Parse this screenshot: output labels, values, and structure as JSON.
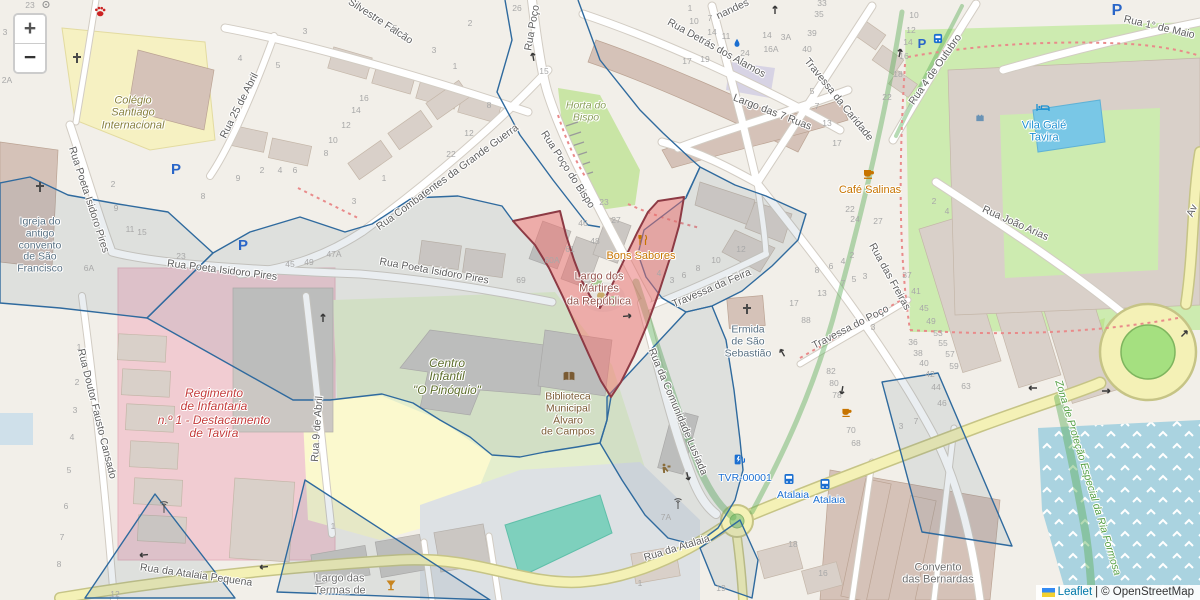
{
  "map": {
    "controls": {
      "zoom_in": "+",
      "zoom_out": "−"
    },
    "attribution": {
      "leaflet": "Leaflet",
      "separator": "|",
      "copyright": "© OpenStreetMap"
    },
    "colors": {
      "street_label": "#5f5f5f",
      "housenumber": "#a8a8a8",
      "poi_orange": "#c77400",
      "poi_blue": "#1a8fd1",
      "poi_transit_blue": "#1b6fd1",
      "church_label": "#587082",
      "school_label": "#88813d",
      "kindergarten_label": "#5d6e2c",
      "military_label": "#c43c3c",
      "square_label": "#96544d",
      "library_label": "#7a5b33",
      "protection_label": "#55a044",
      "place_label": "#6e6e6e",
      "green_area_label": "#8ba05a",
      "selection_outline": "#2f6a9e",
      "highlight_fill": "#e76a6a",
      "highlight_border": "#8d3a44"
    },
    "labels": [
      {
        "t": "Silvestre Falcão",
        "x": 380,
        "y": 22,
        "rot": 33,
        "cls": "street"
      },
      {
        "t": "Rua Detrás dos Alamos",
        "x": 716,
        "y": 49,
        "rot": 29,
        "cls": "street"
      },
      {
        "t": "nandes",
        "x": 733,
        "y": 10,
        "rot": -25,
        "cls": "street"
      },
      {
        "t": "Rua Poço",
        "x": 533,
        "y": 28,
        "rot": -80,
        "cls": "street"
      },
      {
        "t": "Rua Poço do Bispo",
        "x": 567,
        "y": 170,
        "rot": 57,
        "cls": "street"
      },
      {
        "t": "Rua Combatentes da Grande Guerra",
        "x": 448,
        "y": 178,
        "rot": -36,
        "cls": "street"
      },
      {
        "t": "Rua 25 de Abril",
        "x": 240,
        "y": 106,
        "rot": -63,
        "cls": "street"
      },
      {
        "t": "Rua Poeta Isidoro Pires",
        "x": 88,
        "y": 200,
        "rot": 72,
        "cls": "street"
      },
      {
        "t": "Rua Poeta Isidoro Pires",
        "x": 222,
        "y": 271,
        "rot": 7,
        "cls": "street"
      },
      {
        "t": "Rua Poeta Isidoro Pires",
        "x": 434,
        "y": 272,
        "rot": 10,
        "cls": "street"
      },
      {
        "t": "Largo das 7 Ruas",
        "x": 772,
        "y": 113,
        "rot": 21,
        "cls": "street"
      },
      {
        "t": "Travessa da Caridade",
        "x": 838,
        "y": 100,
        "rot": 51,
        "cls": "street"
      },
      {
        "t": "Rua 4 de Outubro",
        "x": 936,
        "y": 70,
        "rot": -55,
        "cls": "street"
      },
      {
        "t": "Rua 1° de Maio",
        "x": 1159,
        "y": 28,
        "rot": 13,
        "cls": "street"
      },
      {
        "t": "Rua João Arias",
        "x": 1015,
        "y": 224,
        "rot": 24,
        "cls": "street"
      },
      {
        "t": "Rua das Freiras",
        "x": 889,
        "y": 277,
        "rot": 61,
        "cls": "street"
      },
      {
        "t": "Travessa do Poço",
        "x": 851,
        "y": 328,
        "rot": -27,
        "cls": "street"
      },
      {
        "t": "Travessa da Feira",
        "x": 712,
        "y": 289,
        "rot": -23,
        "cls": "street"
      },
      {
        "t": "Rua da Comunidade Lusíada",
        "x": 677,
        "y": 412,
        "rot": 67,
        "cls": "street"
      },
      {
        "t": "Rua Doutor Fausto Cansado",
        "x": 96,
        "y": 414,
        "rot": 76,
        "cls": "street"
      },
      {
        "t": "Rua 9 de Abril",
        "x": 318,
        "y": 429,
        "rot": -86,
        "cls": "street"
      },
      {
        "t": "Rua da Atalaia",
        "x": 677,
        "y": 549,
        "rot": -17,
        "cls": "street"
      },
      {
        "t": "Rua da Atalaia Pequena",
        "x": 196,
        "y": 576,
        "rot": 8,
        "cls": "street"
      },
      {
        "t": "Av",
        "x": 1193,
        "y": 211,
        "rot": -65,
        "cls": "street"
      },
      {
        "t": "Colégio\nSantiago\nInternacional",
        "x": 133,
        "y": 113,
        "c": "#88813d",
        "s": 11,
        "i": 1,
        "n": "label-colegio-santiago"
      },
      {
        "t": "Igreja do\nantigo\nconvento\nde São\nFrancisco",
        "x": 40,
        "y": 246,
        "c": "#587082",
        "s": 10.5,
        "n": "label-igreja-sao-francisco"
      },
      {
        "t": "Horta do\nBispo",
        "x": 586,
        "y": 112,
        "c": "#8ba05a",
        "s": 10.5,
        "i": 1,
        "n": "label-horta-do-bispo"
      },
      {
        "t": "Café Salinas",
        "x": 870,
        "y": 190,
        "c": "#c77400",
        "s": 11,
        "n": "label-cafe-salinas"
      },
      {
        "t": "Bons Sabores",
        "x": 641,
        "y": 256,
        "c": "#c77400",
        "s": 11,
        "n": "label-bons-sabores"
      },
      {
        "t": "Largo dos\nMártires\nda República",
        "x": 599,
        "y": 289,
        "c": "#96544d",
        "s": 11,
        "n": "label-largo-martires"
      },
      {
        "t": "Regimento\nde Infantaria\nn.º 1 - Destacamento\nde Tavira",
        "x": 214,
        "y": 414,
        "c": "#c43c3c",
        "s": 12,
        "i": 1,
        "n": "label-regimento-infantaria"
      },
      {
        "t": "Centro\nInfantil\n\"O Pinóquio\"",
        "x": 447,
        "y": 377,
        "c": "#5d6e2c",
        "s": 12,
        "i": 1,
        "n": "label-centro-infantil"
      },
      {
        "t": "Biblioteca\nMunicipal\nÁlvaro\nde Campos",
        "x": 568,
        "y": 415,
        "c": "#7a5b33",
        "s": 10.5,
        "n": "label-biblioteca"
      },
      {
        "t": "Ermida\nde São\nSebastião",
        "x": 748,
        "y": 342,
        "c": "#587082",
        "s": 10.5,
        "n": "label-ermida"
      },
      {
        "t": "Vila Galé\nTavira",
        "x": 1044,
        "y": 132,
        "c": "#1a8fd1",
        "s": 11,
        "n": "label-vila-gale"
      },
      {
        "t": "TVR-00001",
        "x": 745,
        "y": 479,
        "c": "#1b6fd1",
        "s": 10.5,
        "n": "label-tvr"
      },
      {
        "t": "Atalaia",
        "x": 793,
        "y": 496,
        "c": "#1b6fd1",
        "s": 10.5,
        "n": "label-busstop-atalaia-1"
      },
      {
        "t": "Atalaia",
        "x": 829,
        "y": 501,
        "c": "#1b6fd1",
        "s": 10.5,
        "n": "label-busstop-atalaia-2"
      },
      {
        "t": "Convento\ndas Bernardas",
        "x": 938,
        "y": 574,
        "c": "#6e6e6e",
        "s": 11,
        "n": "label-convento-bernardas"
      },
      {
        "t": "Largo das\nTermas de",
        "x": 340,
        "y": 585,
        "c": "#6e6e6e",
        "s": 11,
        "n": "label-largo-termas"
      },
      {
        "t": "Zona de Proteção Especial da Ria Formosa",
        "x": 1087,
        "y": 478,
        "rot": 73,
        "c": "#55a044",
        "s": 10.5,
        "i": 1,
        "n": "label-zona-protecao"
      }
    ],
    "housenumbers": [
      [
        "23",
        30,
        6
      ],
      [
        "2A",
        7,
        81
      ],
      [
        "3",
        5,
        33
      ],
      [
        "4",
        240,
        59
      ],
      [
        "5",
        278,
        66
      ],
      [
        "2",
        262,
        171
      ],
      [
        "4",
        280,
        171
      ],
      [
        "6",
        295,
        171
      ],
      [
        "9",
        238,
        179
      ],
      [
        "8",
        203,
        197
      ],
      [
        "2",
        113,
        185
      ],
      [
        "9",
        116,
        209
      ],
      [
        "11",
        130,
        230
      ],
      [
        "15",
        142,
        233
      ],
      [
        "23",
        181,
        257
      ],
      [
        "45",
        290,
        265
      ],
      [
        "6A",
        89,
        269
      ],
      [
        "47A",
        334,
        255
      ],
      [
        "49",
        309,
        263
      ],
      [
        "3",
        305,
        32
      ],
      [
        "5",
        395,
        29
      ],
      [
        "3",
        434,
        51
      ],
      [
        "1",
        455,
        67
      ],
      [
        "2",
        470,
        24
      ],
      [
        "16",
        364,
        99
      ],
      [
        "14",
        356,
        111
      ],
      [
        "12",
        346,
        126
      ],
      [
        "10",
        333,
        141
      ],
      [
        "8",
        326,
        154
      ],
      [
        "12",
        469,
        134
      ],
      [
        "8",
        489,
        106
      ],
      [
        "22",
        451,
        155
      ],
      [
        "1",
        384,
        179
      ],
      [
        "3",
        354,
        202
      ],
      [
        "26",
        517,
        9
      ],
      [
        "15",
        544,
        72
      ],
      [
        "69",
        521,
        281
      ],
      [
        "1",
        690,
        9
      ],
      [
        "10",
        694,
        22
      ],
      [
        "7",
        710,
        19
      ],
      [
        "14",
        712,
        33
      ],
      [
        "11",
        726,
        37
      ],
      [
        "14",
        767,
        36
      ],
      [
        "3A",
        786,
        38
      ],
      [
        "16A",
        771,
        50
      ],
      [
        "24",
        745,
        54
      ],
      [
        "17",
        687,
        62
      ],
      [
        "19",
        705,
        60
      ],
      [
        "33",
        822,
        4
      ],
      [
        "35",
        819,
        15
      ],
      [
        "39",
        812,
        34
      ],
      [
        "40",
        807,
        50
      ],
      [
        "5",
        812,
        92
      ],
      [
        "7",
        817,
        107
      ],
      [
        "13",
        827,
        124
      ],
      [
        "17",
        837,
        144
      ],
      [
        "10",
        914,
        16
      ],
      [
        "12",
        911,
        31
      ],
      [
        "14",
        908,
        43
      ],
      [
        "16",
        904,
        57
      ],
      [
        "18",
        898,
        75
      ],
      [
        "22",
        887,
        98
      ],
      [
        "22",
        850,
        210
      ],
      [
        "24",
        855,
        220
      ],
      [
        "27",
        878,
        222
      ],
      [
        "2",
        852,
        256
      ],
      [
        "4",
        843,
        262
      ],
      [
        "6",
        831,
        267
      ],
      [
        "8",
        817,
        271
      ],
      [
        "7",
        843,
        284
      ],
      [
        "5",
        854,
        280
      ],
      [
        "3",
        865,
        277
      ],
      [
        "13",
        822,
        294
      ],
      [
        "88",
        806,
        321
      ],
      [
        "3",
        873,
        328
      ],
      [
        "37",
        907,
        276
      ],
      [
        "41",
        916,
        292
      ],
      [
        "45",
        924,
        309
      ],
      [
        "49",
        931,
        322
      ],
      [
        "53",
        938,
        334
      ],
      [
        "55",
        943,
        344
      ],
      [
        "57",
        950,
        355
      ],
      [
        "59",
        954,
        367
      ],
      [
        "63",
        966,
        387
      ],
      [
        "36",
        913,
        343
      ],
      [
        "38",
        918,
        354
      ],
      [
        "40",
        924,
        364
      ],
      [
        "42",
        930,
        375
      ],
      [
        "44",
        936,
        388
      ],
      [
        "46",
        942,
        404
      ],
      [
        "2",
        934,
        202
      ],
      [
        "4",
        947,
        212
      ],
      [
        "46",
        583,
        224
      ],
      [
        "48",
        595,
        242
      ],
      [
        "61",
        570,
        250
      ],
      [
        "60A",
        552,
        261
      ],
      [
        "23",
        604,
        203
      ],
      [
        "27",
        616,
        221
      ],
      [
        "4",
        659,
        274
      ],
      [
        "3",
        672,
        281
      ],
      [
        "6",
        684,
        276
      ],
      [
        "8",
        698,
        269
      ],
      [
        "10",
        716,
        261
      ],
      [
        "12",
        741,
        250
      ],
      [
        "17",
        794,
        304
      ],
      [
        "82",
        831,
        372
      ],
      [
        "80",
        834,
        384
      ],
      [
        "78",
        837,
        396
      ],
      [
        "70",
        851,
        431
      ],
      [
        "68",
        856,
        444
      ],
      [
        "18",
        793,
        545
      ],
      [
        "16",
        823,
        574
      ],
      [
        "19",
        721,
        589
      ],
      [
        "7A",
        666,
        518
      ],
      [
        "1",
        640,
        584
      ],
      [
        "1",
        333,
        527
      ],
      [
        "3",
        901,
        427
      ],
      [
        "7",
        916,
        422
      ],
      [
        "1",
        79,
        348
      ],
      [
        "2",
        77,
        383
      ],
      [
        "3",
        75,
        411
      ],
      [
        "4",
        72,
        438
      ],
      [
        "5",
        69,
        471
      ],
      [
        "6",
        66,
        507
      ],
      [
        "7",
        62,
        538
      ],
      [
        "8",
        59,
        565
      ],
      [
        "12",
        115,
        595
      ]
    ],
    "icons": [
      {
        "k": "paw",
        "x": 100,
        "y": 14,
        "c": "#cc2222",
        "s": 13,
        "n": "veterinary-paw-icon"
      },
      {
        "k": "well",
        "x": 46,
        "y": 5,
        "c": "#909090",
        "s": 9,
        "n": "well-icon"
      },
      {
        "k": "cross",
        "x": 77,
        "y": 60,
        "c": "#4a4a4a",
        "s": 12,
        "n": "church-cross-icon"
      },
      {
        "k": "cross",
        "x": 40,
        "y": 189,
        "c": "#4a4a4a",
        "s": 12,
        "n": "church-cross-icon"
      },
      {
        "k": "cross",
        "x": 747,
        "y": 311,
        "c": "#4a4a4a",
        "s": 12,
        "n": "church-cross-icon"
      },
      {
        "k": "cup",
        "x": 869,
        "y": 176,
        "c": "#c77400",
        "s": 12,
        "n": "cafe-icon"
      },
      {
        "k": "cup",
        "x": 847,
        "y": 414,
        "c": "#c77400",
        "s": 11,
        "n": "cafe-icon"
      },
      {
        "k": "fork",
        "x": 643,
        "y": 242,
        "c": "#c77400",
        "s": 12,
        "n": "restaurant-icon"
      },
      {
        "k": "book",
        "x": 569,
        "y": 379,
        "c": "#7a5b33",
        "s": 13,
        "n": "library-icon"
      },
      {
        "k": "bed",
        "x": 1043,
        "y": 109,
        "c": "#1a8fd1",
        "s": 12,
        "n": "hotel-bed-icon"
      },
      {
        "k": "fort",
        "x": 980,
        "y": 119,
        "c": "#6a93b5",
        "s": 11,
        "n": "fort-icon"
      },
      {
        "k": "cocktail",
        "x": 391,
        "y": 587,
        "c": "#c8851f",
        "s": 12,
        "n": "bar-cocktail-icon"
      },
      {
        "k": "parking",
        "x": 176,
        "y": 170,
        "c": "#2a66c8",
        "s": 15,
        "n": "parking-icon"
      },
      {
        "k": "parking",
        "x": 243,
        "y": 246,
        "c": "#2a66c8",
        "s": 15,
        "n": "parking-icon"
      },
      {
        "k": "parking",
        "x": 922,
        "y": 44,
        "c": "#2a66c8",
        "s": 13,
        "n": "parking-icon"
      },
      {
        "k": "parking",
        "x": 1117,
        "y": 11,
        "c": "#2a66c8",
        "s": 16,
        "n": "parking-icon"
      },
      {
        "k": "transit",
        "x": 938,
        "y": 40,
        "c": "#1b6fd1",
        "s": 11,
        "n": "transit-icon"
      },
      {
        "k": "water",
        "x": 737,
        "y": 44,
        "c": "#1b6fd1",
        "s": 10,
        "n": "drinking-water-icon"
      },
      {
        "k": "bus",
        "x": 789,
        "y": 481,
        "c": "#1b6fd1",
        "s": 12,
        "n": "bus-stop-icon"
      },
      {
        "k": "bus",
        "x": 825,
        "y": 486,
        "c": "#1b6fd1",
        "s": 12,
        "n": "bus-stop-icon"
      },
      {
        "k": "charge",
        "x": 739,
        "y": 462,
        "c": "#1b6fd1",
        "s": 13,
        "n": "charging-station-icon"
      },
      {
        "k": "antenna",
        "x": 164,
        "y": 510,
        "c": "#555555",
        "s": 13,
        "n": "antenna-icon"
      },
      {
        "k": "antenna",
        "x": 678,
        "y": 506,
        "c": "#555555",
        "s": 12,
        "n": "antenna-icon"
      },
      {
        "k": "works",
        "x": 666,
        "y": 470,
        "c": "#8a6d3b",
        "s": 12,
        "n": "works-icon"
      },
      {
        "k": "arrow",
        "x": 775,
        "y": 9,
        "rot": -90,
        "c": "#3a3a3a",
        "s": 8,
        "n": "oneway-arrow-icon"
      },
      {
        "k": "arrow",
        "x": 533,
        "y": 56,
        "rot": -100,
        "c": "#3a3a3a",
        "s": 8,
        "n": "oneway-arrow-icon"
      },
      {
        "k": "arrow",
        "x": 323,
        "y": 317,
        "rot": -90,
        "c": "#3a3a3a",
        "s": 8,
        "n": "oneway-arrow-icon"
      },
      {
        "k": "arrow",
        "x": 628,
        "y": 316,
        "rot": -5,
        "c": "#3a3a3a",
        "s": 8,
        "n": "oneway-arrow-icon"
      },
      {
        "k": "arrow",
        "x": 782,
        "y": 352,
        "rot": -120,
        "c": "#3a3a3a",
        "s": 8,
        "n": "oneway-arrow-icon"
      },
      {
        "k": "arrow",
        "x": 842,
        "y": 391,
        "rot": 100,
        "c": "#3a3a3a",
        "s": 8,
        "n": "oneway-arrow-icon"
      },
      {
        "k": "arrow",
        "x": 900,
        "y": 52,
        "rot": -80,
        "c": "#3a3a3a",
        "s": 8,
        "n": "oneway-arrow-icon"
      },
      {
        "k": "arrow",
        "x": 1032,
        "y": 388,
        "rot": 180,
        "c": "#3a3a3a",
        "s": 8,
        "n": "oneway-arrow-icon"
      },
      {
        "k": "arrow",
        "x": 1107,
        "y": 391,
        "rot": 0,
        "c": "#3a3a3a",
        "s": 8,
        "n": "oneway-arrow-icon"
      },
      {
        "k": "arrow",
        "x": 1185,
        "y": 333,
        "rot": -45,
        "c": "#3a3a3a",
        "s": 8,
        "n": "oneway-arrow-icon"
      },
      {
        "k": "arrow",
        "x": 143,
        "y": 555,
        "rot": 175,
        "c": "#3a3a3a",
        "s": 8,
        "n": "oneway-arrow-icon"
      },
      {
        "k": "arrow",
        "x": 263,
        "y": 567,
        "rot": 175,
        "c": "#3a3a3a",
        "s": 8,
        "n": "oneway-arrow-icon"
      },
      {
        "k": "arrow",
        "x": 688,
        "y": 477,
        "rot": 75,
        "c": "#3a3a3a",
        "s": 8,
        "n": "oneway-arrow-icon"
      }
    ]
  }
}
